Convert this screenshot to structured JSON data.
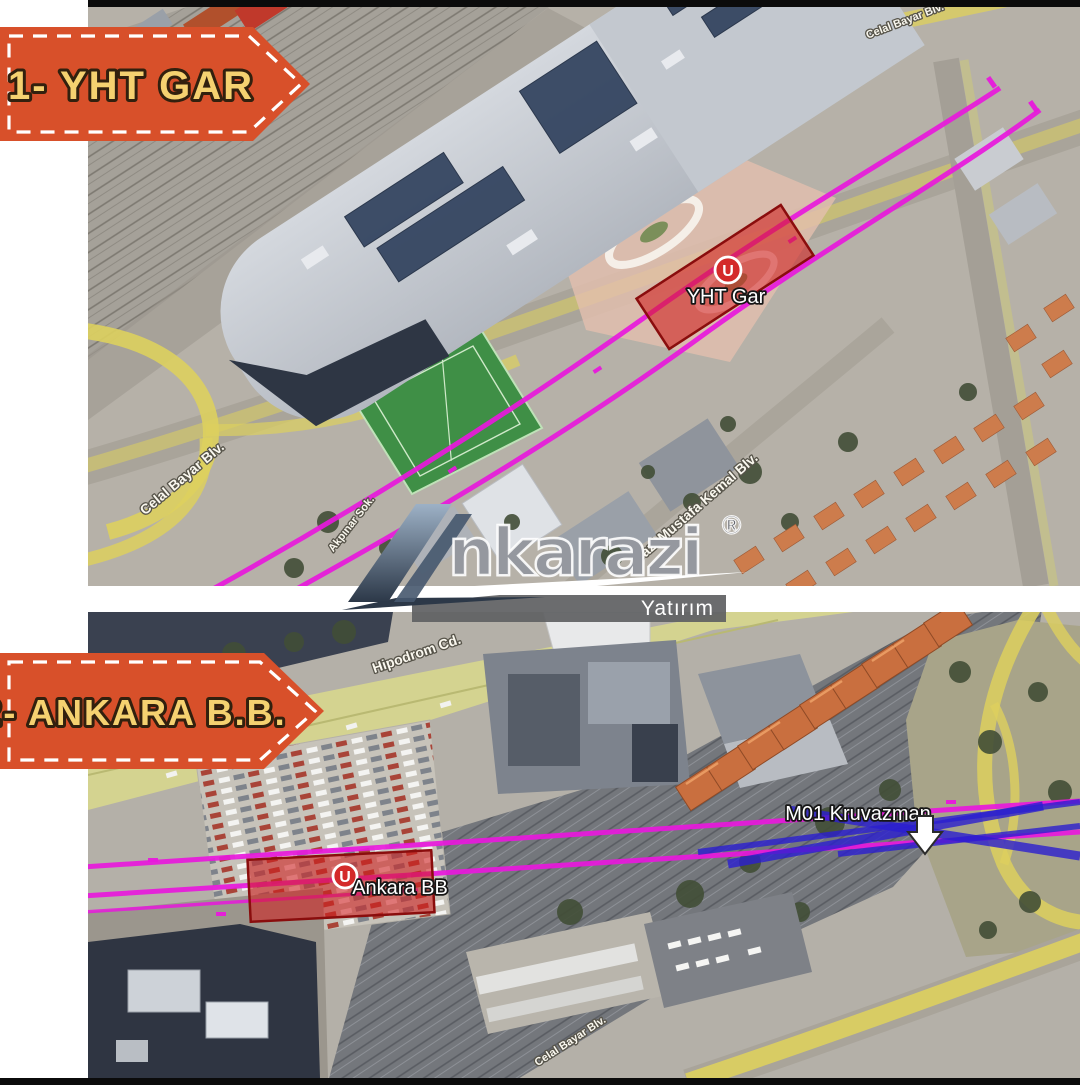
{
  "sections": {
    "one": {
      "ribbon": "1- YHT GAR"
    },
    "two": {
      "ribbon": "2- ANKARA B.B."
    }
  },
  "map_top": {
    "station_icon": "U",
    "station_name": "YHT Gar",
    "streets": {
      "celal_bayar_left": "Celal Bayar Blv.",
      "celal_bayar_top_right": "Celal Bayar Blv.",
      "gazi_mustafa_kemal": "Gazi Mustafa Kemal Blv.",
      "akpinar": "Akpınar Sok."
    }
  },
  "map_bottom": {
    "station_icon": "U",
    "station_name": "Ankara BB",
    "crossover": "M01 Kruvazman",
    "streets": {
      "hipodrom": "Hipodrom Cd.",
      "celal_bayar_bottom": "Celal Bayar Blv."
    }
  },
  "watermark": {
    "brand": "nkarazi",
    "registered": "®",
    "subtitle": "Yatırım"
  },
  "colors": {
    "ribbon-bg": "#d8502a",
    "ribbon-text": "#f5d170",
    "metro-line": "#e818dc",
    "crossover-line": "#2a1ed0",
    "station-zone": "#d01d1d",
    "station-marker": "#d42a2a",
    "road-highlight": "#ddd05e"
  }
}
